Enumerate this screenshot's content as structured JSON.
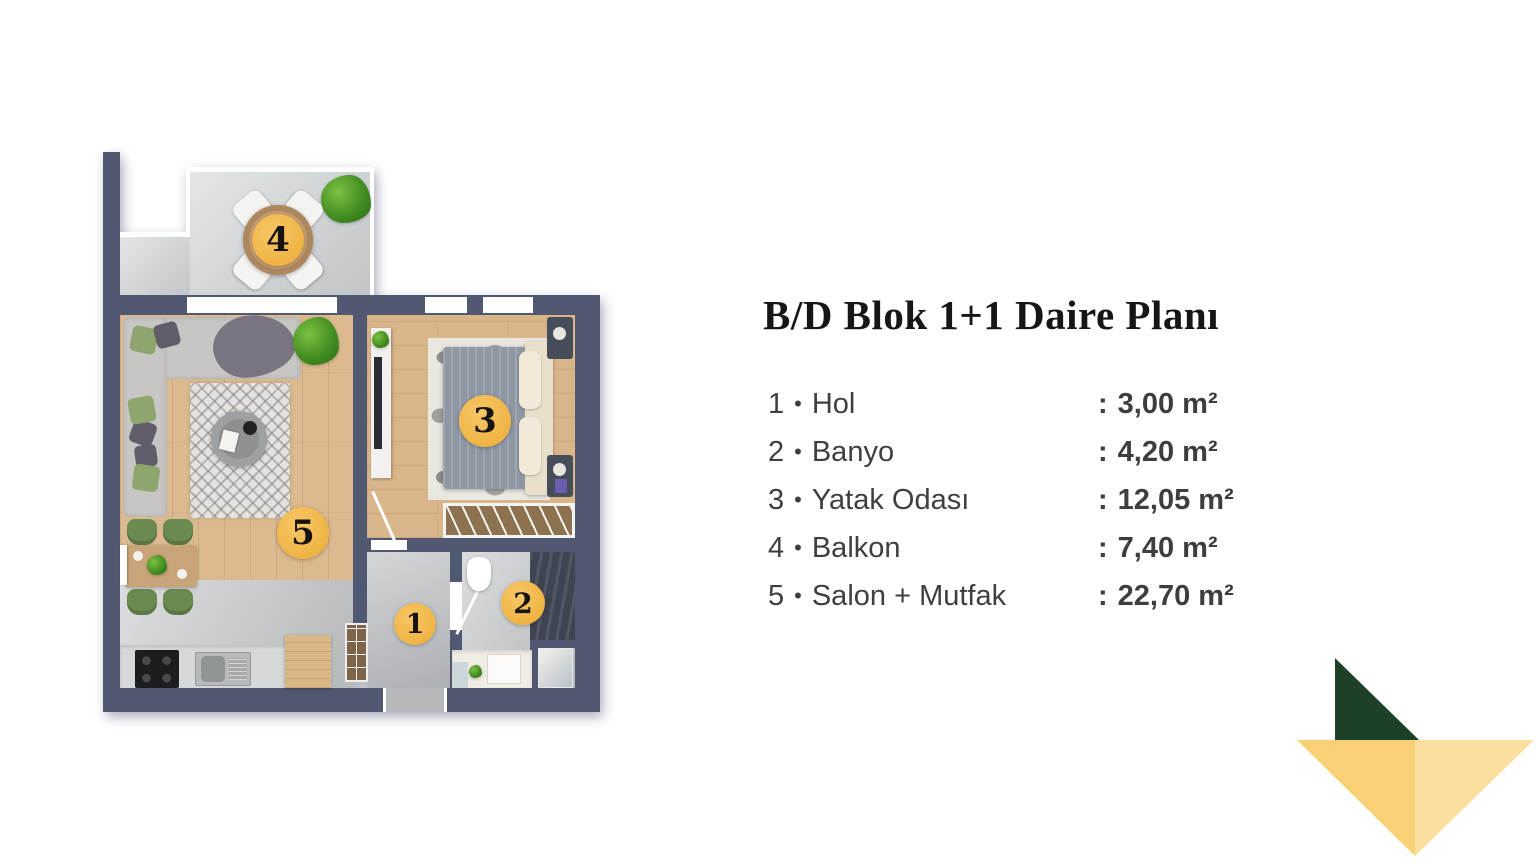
{
  "title": "B/D Blok 1+1 Daire Planı",
  "legend": {
    "separator": "•",
    "colon": ":",
    "items": [
      {
        "num": "1",
        "name": "Hol",
        "area": "3,00 m²"
      },
      {
        "num": "2",
        "name": "Banyo",
        "area": "4,20 m²"
      },
      {
        "num": "3",
        "name": "Yatak Odası",
        "area": "12,05 m²"
      },
      {
        "num": "4",
        "name": "Balkon",
        "area": "7,40 m²"
      },
      {
        "num": "5",
        "name": "Salon + Mutfak",
        "area": "22,70 m²"
      }
    ]
  },
  "floorplan": {
    "markers": [
      {
        "label": "1"
      },
      {
        "label": "2"
      },
      {
        "label": "3"
      },
      {
        "label": "4"
      },
      {
        "label": "5"
      }
    ]
  },
  "colors": {
    "marker": "#f1ba4e",
    "wall": "#505971",
    "title_text": "#161616",
    "legend_text": "#3f3f3f",
    "logo_green": "#1d4127",
    "logo_yellow_left": "#f8d075",
    "logo_yellow_right": "#fbdf9f"
  }
}
